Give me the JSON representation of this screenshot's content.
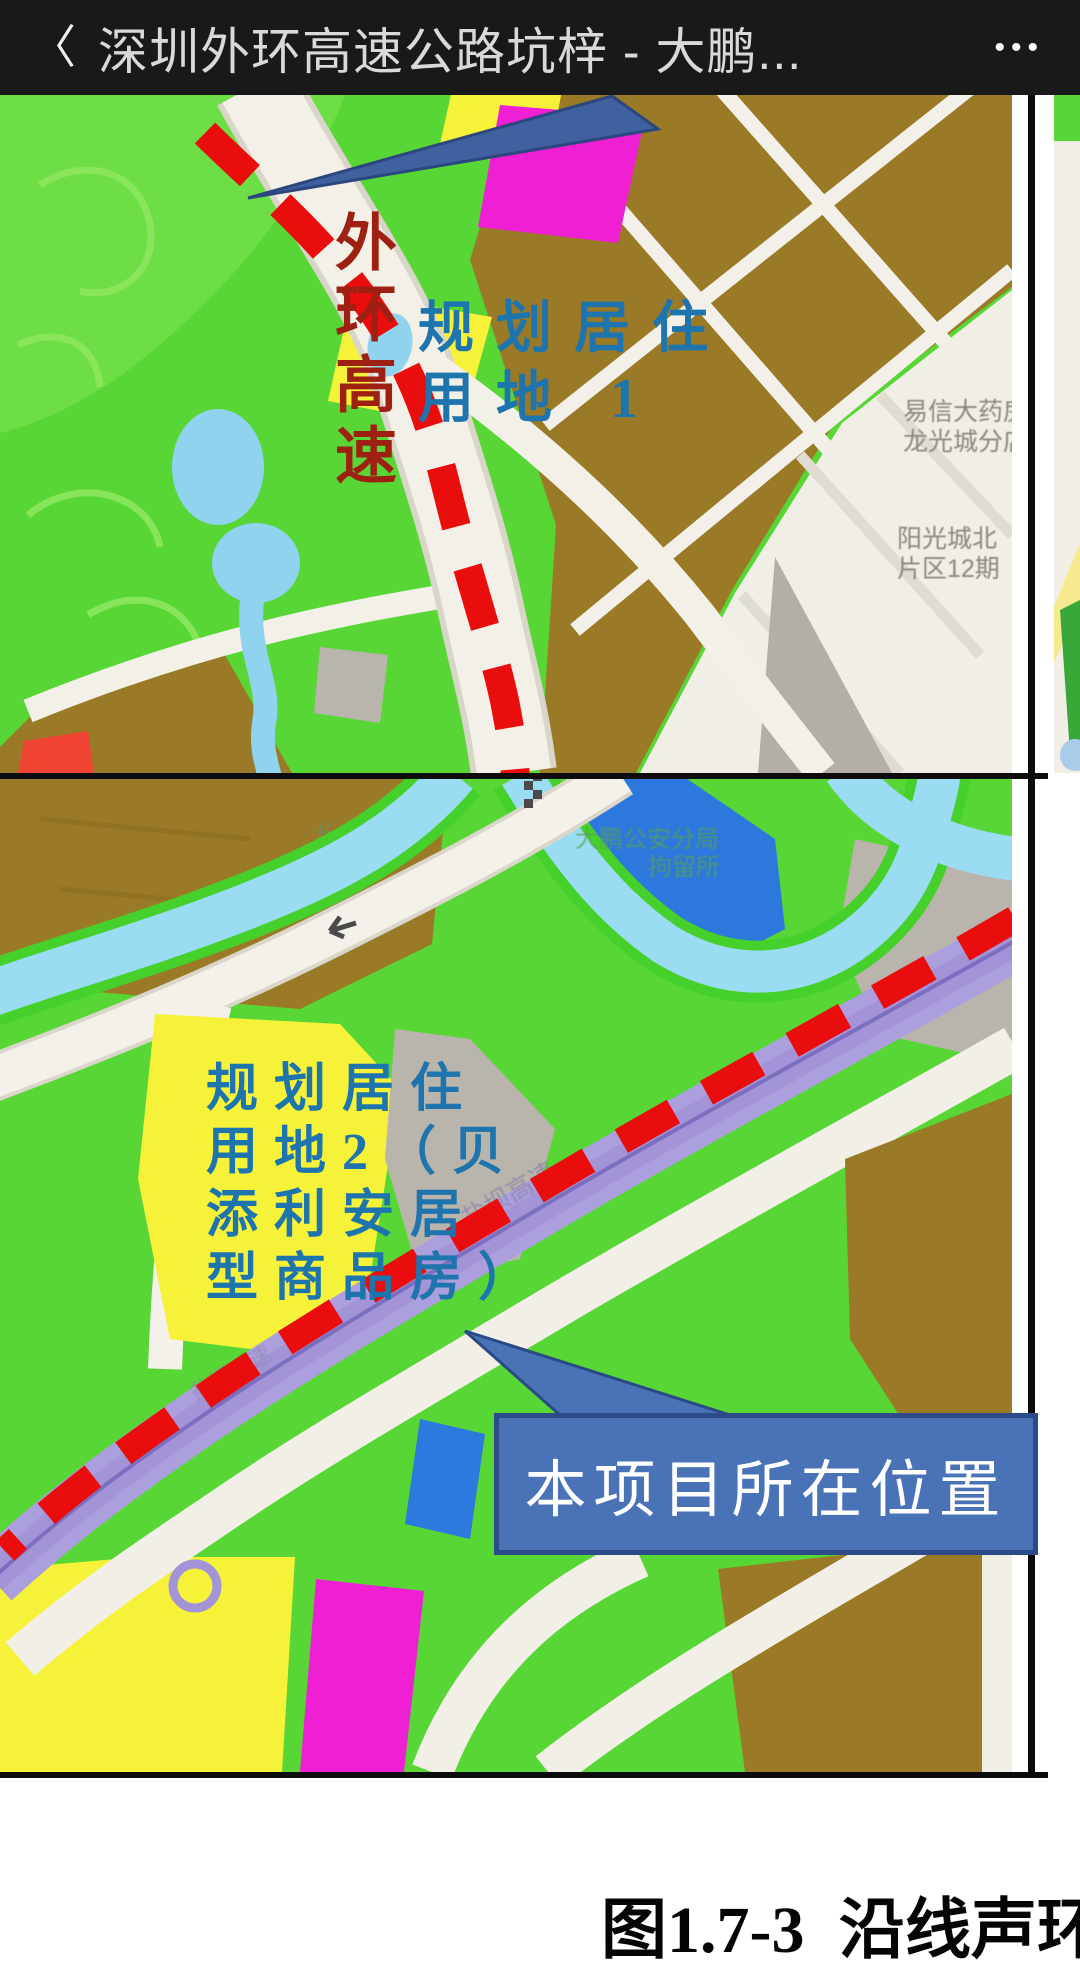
{
  "header": {
    "back_icon": "〈",
    "title": "深圳外环高速公路坑梓 - 大鹏...",
    "menu_icon": "•••"
  },
  "top_map": {
    "route_label_vertical": "外环高速",
    "planning_area_1": {
      "line1": "规划居住",
      "line2": "用地 1"
    },
    "poi": {
      "pharmacy_line1": "易信大药房",
      "pharmacy_line2": "龙光城分店",
      "block_line1": "阳光城北",
      "block_line2": "片区12期"
    }
  },
  "bottom_map": {
    "planning_area_2": {
      "line1": "规划居住",
      "line2": "用地2（贝",
      "line3": "添利安居",
      "line4": "型商品房）"
    },
    "callout_label": "本项目所在位置",
    "poi": {
      "reservoir": "· 长者碧水库",
      "police_line1": "大鹏公安分局",
      "police_line2": "拘留所",
      "highway_label": "盐坝高速",
      "highway_label2": "盐坝高速"
    }
  },
  "caption": "图1.7-3 沿线声环",
  "colors": {
    "header_bg": "#191919",
    "route_dash_red": "#ea0d0d",
    "annotation_blue": "#1e74ac",
    "annotation_dark_red": "#9e2012",
    "callout_bg": "#4a73b7",
    "callout_border": "#2b4c88",
    "highway_purple": "#ab9fdd",
    "map_green": "#57d636",
    "map_brown": "#9a7a26"
  }
}
